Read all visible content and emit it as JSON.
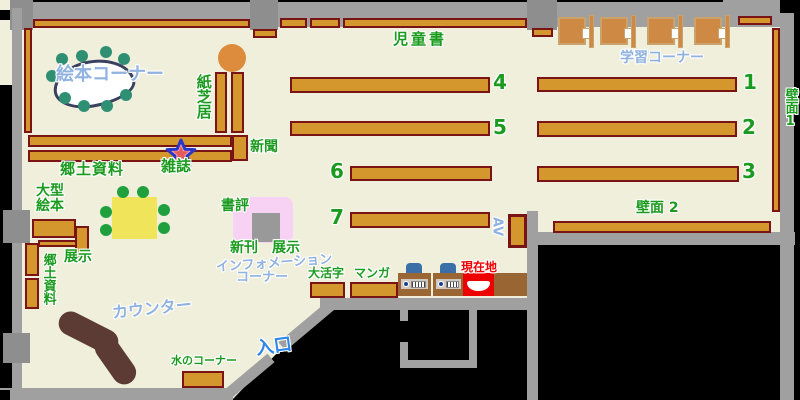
{
  "map_title": "library-floor-map",
  "labels": {
    "jidosho": "児童書",
    "gakushu_corner": "学習コーナー",
    "hekimen1": "壁面1",
    "hekimen2": "壁面 2",
    "ehon_corner": "絵本コーナー",
    "kamishibai": "紙芝居",
    "shimbun": "新聞",
    "zasshi": "雑誌",
    "kyodo_shiryo": "郷土資料",
    "ogata_ehon_line1": "大型",
    "ogata_ehon_line2": "絵本",
    "tenji_shelf": "展示",
    "kyodo_shiryo_vertical": "郷土資料",
    "shohyo": "書評",
    "shinkan": "新刊",
    "tenji_display": "展示",
    "information_line1": "インフォメーション",
    "information_line2": "コーナー",
    "daikatsuji": "大活字",
    "manga": "マンガ",
    "genzaichi": "現在地",
    "av": "AV",
    "counter": "カウンター",
    "mizu_corner": "水のコーナー",
    "iriguchi": "入口"
  },
  "numbers": {
    "n1": "1",
    "n2": "2",
    "n3": "3",
    "n4": "4",
    "n5": "5",
    "n6": "6",
    "n7": "7"
  },
  "colors": {
    "floor": "#F0EFDC",
    "outside": "#000000",
    "wall_gray": "#A0A0A0",
    "shelf_fill": "#D4972E",
    "shelf_border": "#7A1414",
    "label_green": "#1B9B1E",
    "label_blue_light": "#8FB2E0",
    "label_blue_strong": "#2E86E8",
    "label_red": "#EE0000",
    "counter_brown": "#5D3B35",
    "table_yellow": "#F0E55A",
    "stool_teal": "#2F8F72",
    "stool_green": "#1FA03C",
    "desk_wood": "#CE8A45",
    "kamishibai_stool": "#DC8C3C",
    "display_pink": "#F8D2F4",
    "display_gray": "#999999",
    "opac_brown": "#9A6633",
    "opac_chair_blue": "#3A6FA8",
    "genzaichi_red": "#EE0000",
    "star_fill": "#F6A8B8",
    "star_outline": "#2A36C8",
    "star_core": "#E45A5A"
  }
}
